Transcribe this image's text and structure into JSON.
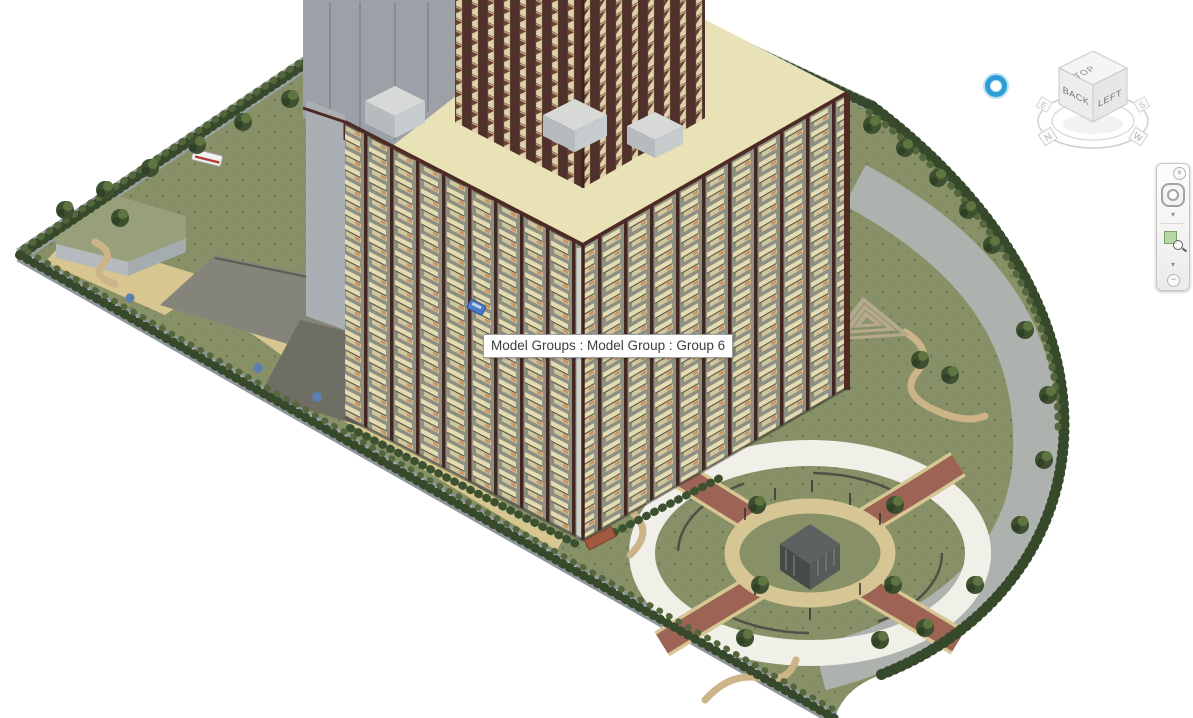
{
  "view3d": {
    "tooltip_text": "Model Groups : Model Group : Group 6"
  },
  "viewcube": {
    "face_top": "TOP",
    "face_back": "BACK",
    "face_left": "LEFT",
    "compass_n": "N",
    "compass_e": "E",
    "compass_s": "S",
    "compass_w": "W"
  },
  "navbar": {
    "close_glyph": "×",
    "collapse_glyph": "−",
    "wheel_caret": "▾",
    "zoom_caret": "▾"
  },
  "cursor": {
    "ring_color": "#2b9cd6"
  },
  "colors": {
    "roof_cream": "#e9e2b6",
    "parapet_maroon": "#4e2a24",
    "corner_maroon": "#40231f",
    "grass_olive": "#879066",
    "road_gray": "#aeb2ae",
    "boundary_wall_gray": "#8f969b",
    "top_band_gray": "#9aa1a5",
    "excavation_dark": "#6f6e64",
    "excavation_mid": "#85847a",
    "path_tan": "#d7c68f",
    "park_ring_white": "#f0f0e8",
    "park_path_red": "#9d6355",
    "park_ring_tan": "#d6c693",
    "core_gray": "#9ba1a6",
    "highlight_car_blue": "#4b79c9"
  }
}
